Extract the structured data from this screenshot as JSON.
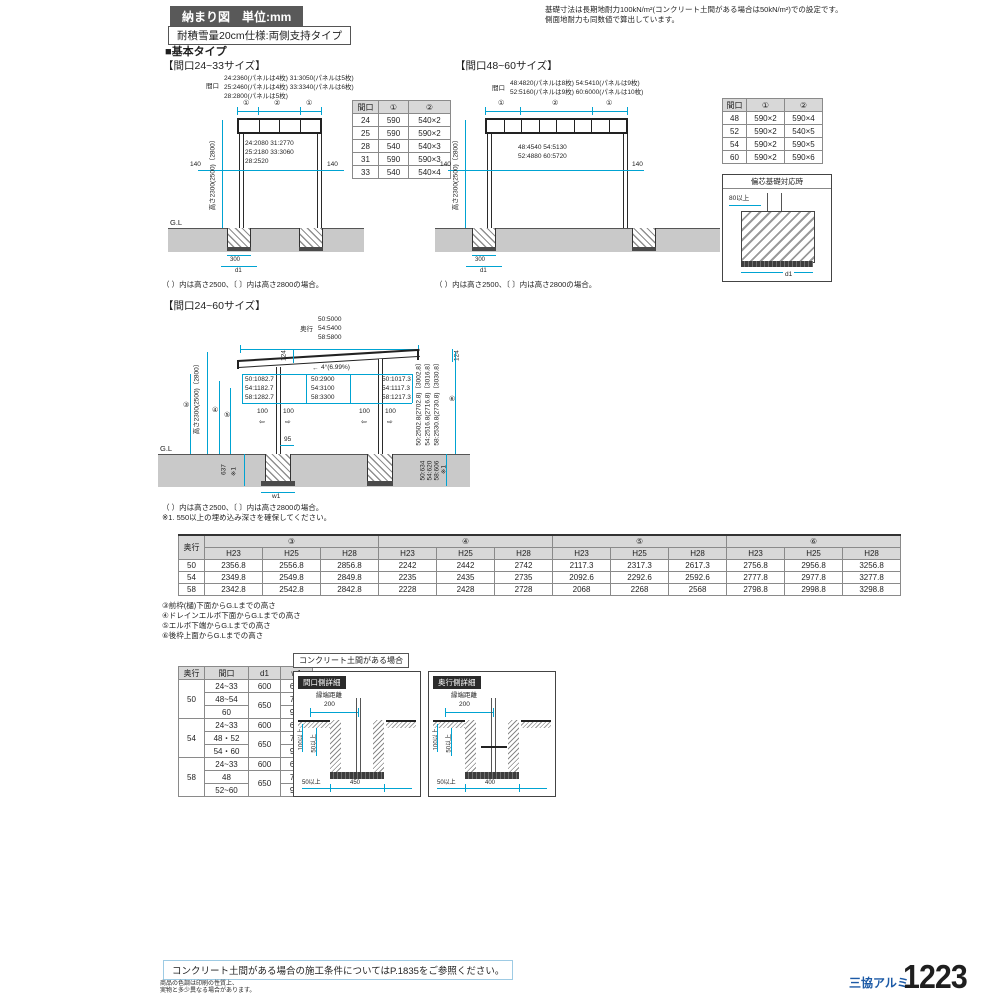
{
  "header": {
    "badge": "納まり図　単位:mm",
    "spec": "耐積雪量20cm仕様:両側支持タイプ",
    "note1": "基礎寸法は長期地耐力100kN/m²(コンクリート土間がある場合は50kN/m²)での設定です。",
    "note2": "側面地耐力も同数値で算出しています。",
    "section": "■基本タイプ"
  },
  "front_small": {
    "title": "【間口24~33サイズ】",
    "span_label": "間口",
    "span1": "24:2360(パネルは4枚) 31:3050(パネルは5枚)",
    "span2": "25:2460(パネルは4枚) 33:3340(パネルは6枚)",
    "span3": "28:2800(パネルは5枚)",
    "seg_a": "①",
    "seg_b": "②",
    "seg_c": "①",
    "inner1": "24:2080 31:2770",
    "inner2": "25:2180 33:3060",
    "inner3": "28:2520",
    "off_left": "140",
    "off_right": "140",
    "height": "高さ2300(2500)〔2800〕",
    "gl": "G.L",
    "f300": "300",
    "fd1": "d1",
    "note": "（ ）内は高さ2500、〔 〕内は高さ2800の場合。",
    "table": {
      "h": [
        "間口",
        "①",
        "②"
      ],
      "rows": [
        [
          "24",
          "590",
          "540×2"
        ],
        [
          "25",
          "590",
          "590×2"
        ],
        [
          "28",
          "540",
          "540×3"
        ],
        [
          "31",
          "590",
          "590×3"
        ],
        [
          "33",
          "540",
          "540×4"
        ]
      ]
    }
  },
  "front_large": {
    "title": "【間口48~60サイズ】",
    "span_label": "間口",
    "span1": "48:4820(パネルは8枚) 54:5410(パネルは9枚)",
    "span2": "52:5160(パネルは9枚) 60:6000(パネルは10枚)",
    "seg_a": "①",
    "seg_b": "②",
    "seg_c": "①",
    "inner1": "48:4540 54:5130",
    "inner2": "52:4880 60:5720",
    "off_left": "140",
    "off_right": "140",
    "height": "高さ2300(2500)〔2800〕",
    "f300": "300",
    "fd1": "d1",
    "note": "（ ）内は高さ2500、〔 〕内は高さ2800の場合。",
    "table": {
      "h": [
        "間口",
        "①",
        "②"
      ],
      "rows": [
        [
          "48",
          "590×2",
          "590×4"
        ],
        [
          "52",
          "590×2",
          "540×5"
        ],
        [
          "54",
          "590×2",
          "590×5"
        ],
        [
          "60",
          "590×2",
          "590×6"
        ]
      ]
    }
  },
  "eccentric": {
    "title": "偏芯基礎対応時",
    "min": "80以上",
    "d1": "d1"
  },
  "side": {
    "title": "【間口24~60サイズ】",
    "depth_label": "奥行",
    "depth1": "50:5000",
    "depth2": "54:5400",
    "depth3": "58:5800",
    "dim124l": "124",
    "dim124r": "124",
    "arrow": "←",
    "slope": "4°(6.99%)",
    "front1": "50:1082.7",
    "front2": "54:1182.7",
    "front3": "58:1282.7",
    "mid1": "50:2900",
    "mid2": "54:3100",
    "mid3": "58:3300",
    "rear1": "50:1017.3",
    "rear2": "54:1117.3",
    "rear3": "58:1217.3",
    "height": "高さ2300(2500)〔2800〕",
    "c3": "③",
    "c4": "④",
    "c5": "⑤",
    "c6": "⑥",
    "d100": "100",
    "arr_l": "⇦",
    "arr_r": "⇨",
    "d95": "95",
    "gl": "G.L",
    "embed": "637",
    "embed_note": "※1",
    "w1": "w1",
    "rh1": "50:2502.8(2702.8)〔3002.8〕",
    "rh2": "54:2516.8(2716.8)〔3016.8〕",
    "rh3": "58:2530.8(2730.8)〔3030.8〕",
    "re1": "50:634",
    "re2": "54:620",
    "re3": "58:606",
    "re_note": "※1",
    "note1": "（ ）内は高さ2500、〔 〕内は高さ2800の場合。",
    "note2": "※1. 550以上の埋め込み深さを確保してください。"
  },
  "height_table": {
    "depth_h": "奥行",
    "groups": [
      "③",
      "④",
      "⑤",
      "⑥"
    ],
    "cols": [
      "H23",
      "H25",
      "H28"
    ],
    "rows": [
      {
        "depth": "50",
        "v": [
          "2356.8",
          "2556.8",
          "2856.8",
          "2242",
          "2442",
          "2742",
          "2117.3",
          "2317.3",
          "2617.3",
          "2756.8",
          "2956.8",
          "3256.8"
        ]
      },
      {
        "depth": "54",
        "v": [
          "2349.8",
          "2549.8",
          "2849.8",
          "2235",
          "2435",
          "2735",
          "2092.6",
          "2292.6",
          "2592.6",
          "2777.8",
          "2977.8",
          "3277.8"
        ]
      },
      {
        "depth": "58",
        "v": [
          "2342.8",
          "2542.8",
          "2842.8",
          "2228",
          "2428",
          "2728",
          "2068",
          "2268",
          "2568",
          "2798.8",
          "2998.8",
          "3298.8"
        ]
      }
    ],
    "legend1": "③前枠(樋)下面からG.Lまでの高さ",
    "legend2": "④ドレインエルボ下面からG.Lまでの高さ",
    "legend3": "⑤エルボ下端からG.Lまでの高さ",
    "legend4": "⑥後枠上面からG.Lまでの高さ"
  },
  "footing_table": {
    "h": [
      "奥行",
      "間口",
      "d1",
      "w1"
    ],
    "g50": {
      "depth": "50",
      "a1": "24~33",
      "d1a": "600",
      "w1a": "600",
      "a2": "48~54",
      "d1b": "650",
      "w1b": "700",
      "a3": "60",
      "w1c": "900"
    },
    "g54": {
      "depth": "54",
      "a1": "24~33",
      "d1a": "600",
      "w1a": "600",
      "a2": "48・52",
      "d1b": "650",
      "w1b": "700",
      "a3": "54・60",
      "w1c": "900"
    },
    "g58": {
      "depth": "58",
      "a1": "24~33",
      "d1a": "600",
      "w1a": "600",
      "a2": "48",
      "d1b": "650",
      "w1b": "700",
      "a3": "52~60",
      "w1c": "900"
    }
  },
  "concrete": {
    "badge": "コンクリート土間がある場合",
    "d1": {
      "title": "間口側詳細",
      "edge": "縁端距離",
      "edge_v": "200",
      "v1": "100以上",
      "v2": "50以上",
      "b1": "50以上",
      "bw": "450"
    },
    "d2": {
      "title": "奥行側詳細",
      "edge": "縁端距離",
      "edge_v": "200",
      "v1": "100以上",
      "v2": "50以上",
      "b1": "50以上",
      "bw": "400"
    }
  },
  "footer": {
    "ref": "コンクリート土間がある場合の施工条件についてはP.1835をご参照ください。",
    "disc1": "商品の色調は印刷の性質上、",
    "disc2": "実物と多少異なる場合があります。",
    "brand": "三協アルミ",
    "page": "1223"
  }
}
